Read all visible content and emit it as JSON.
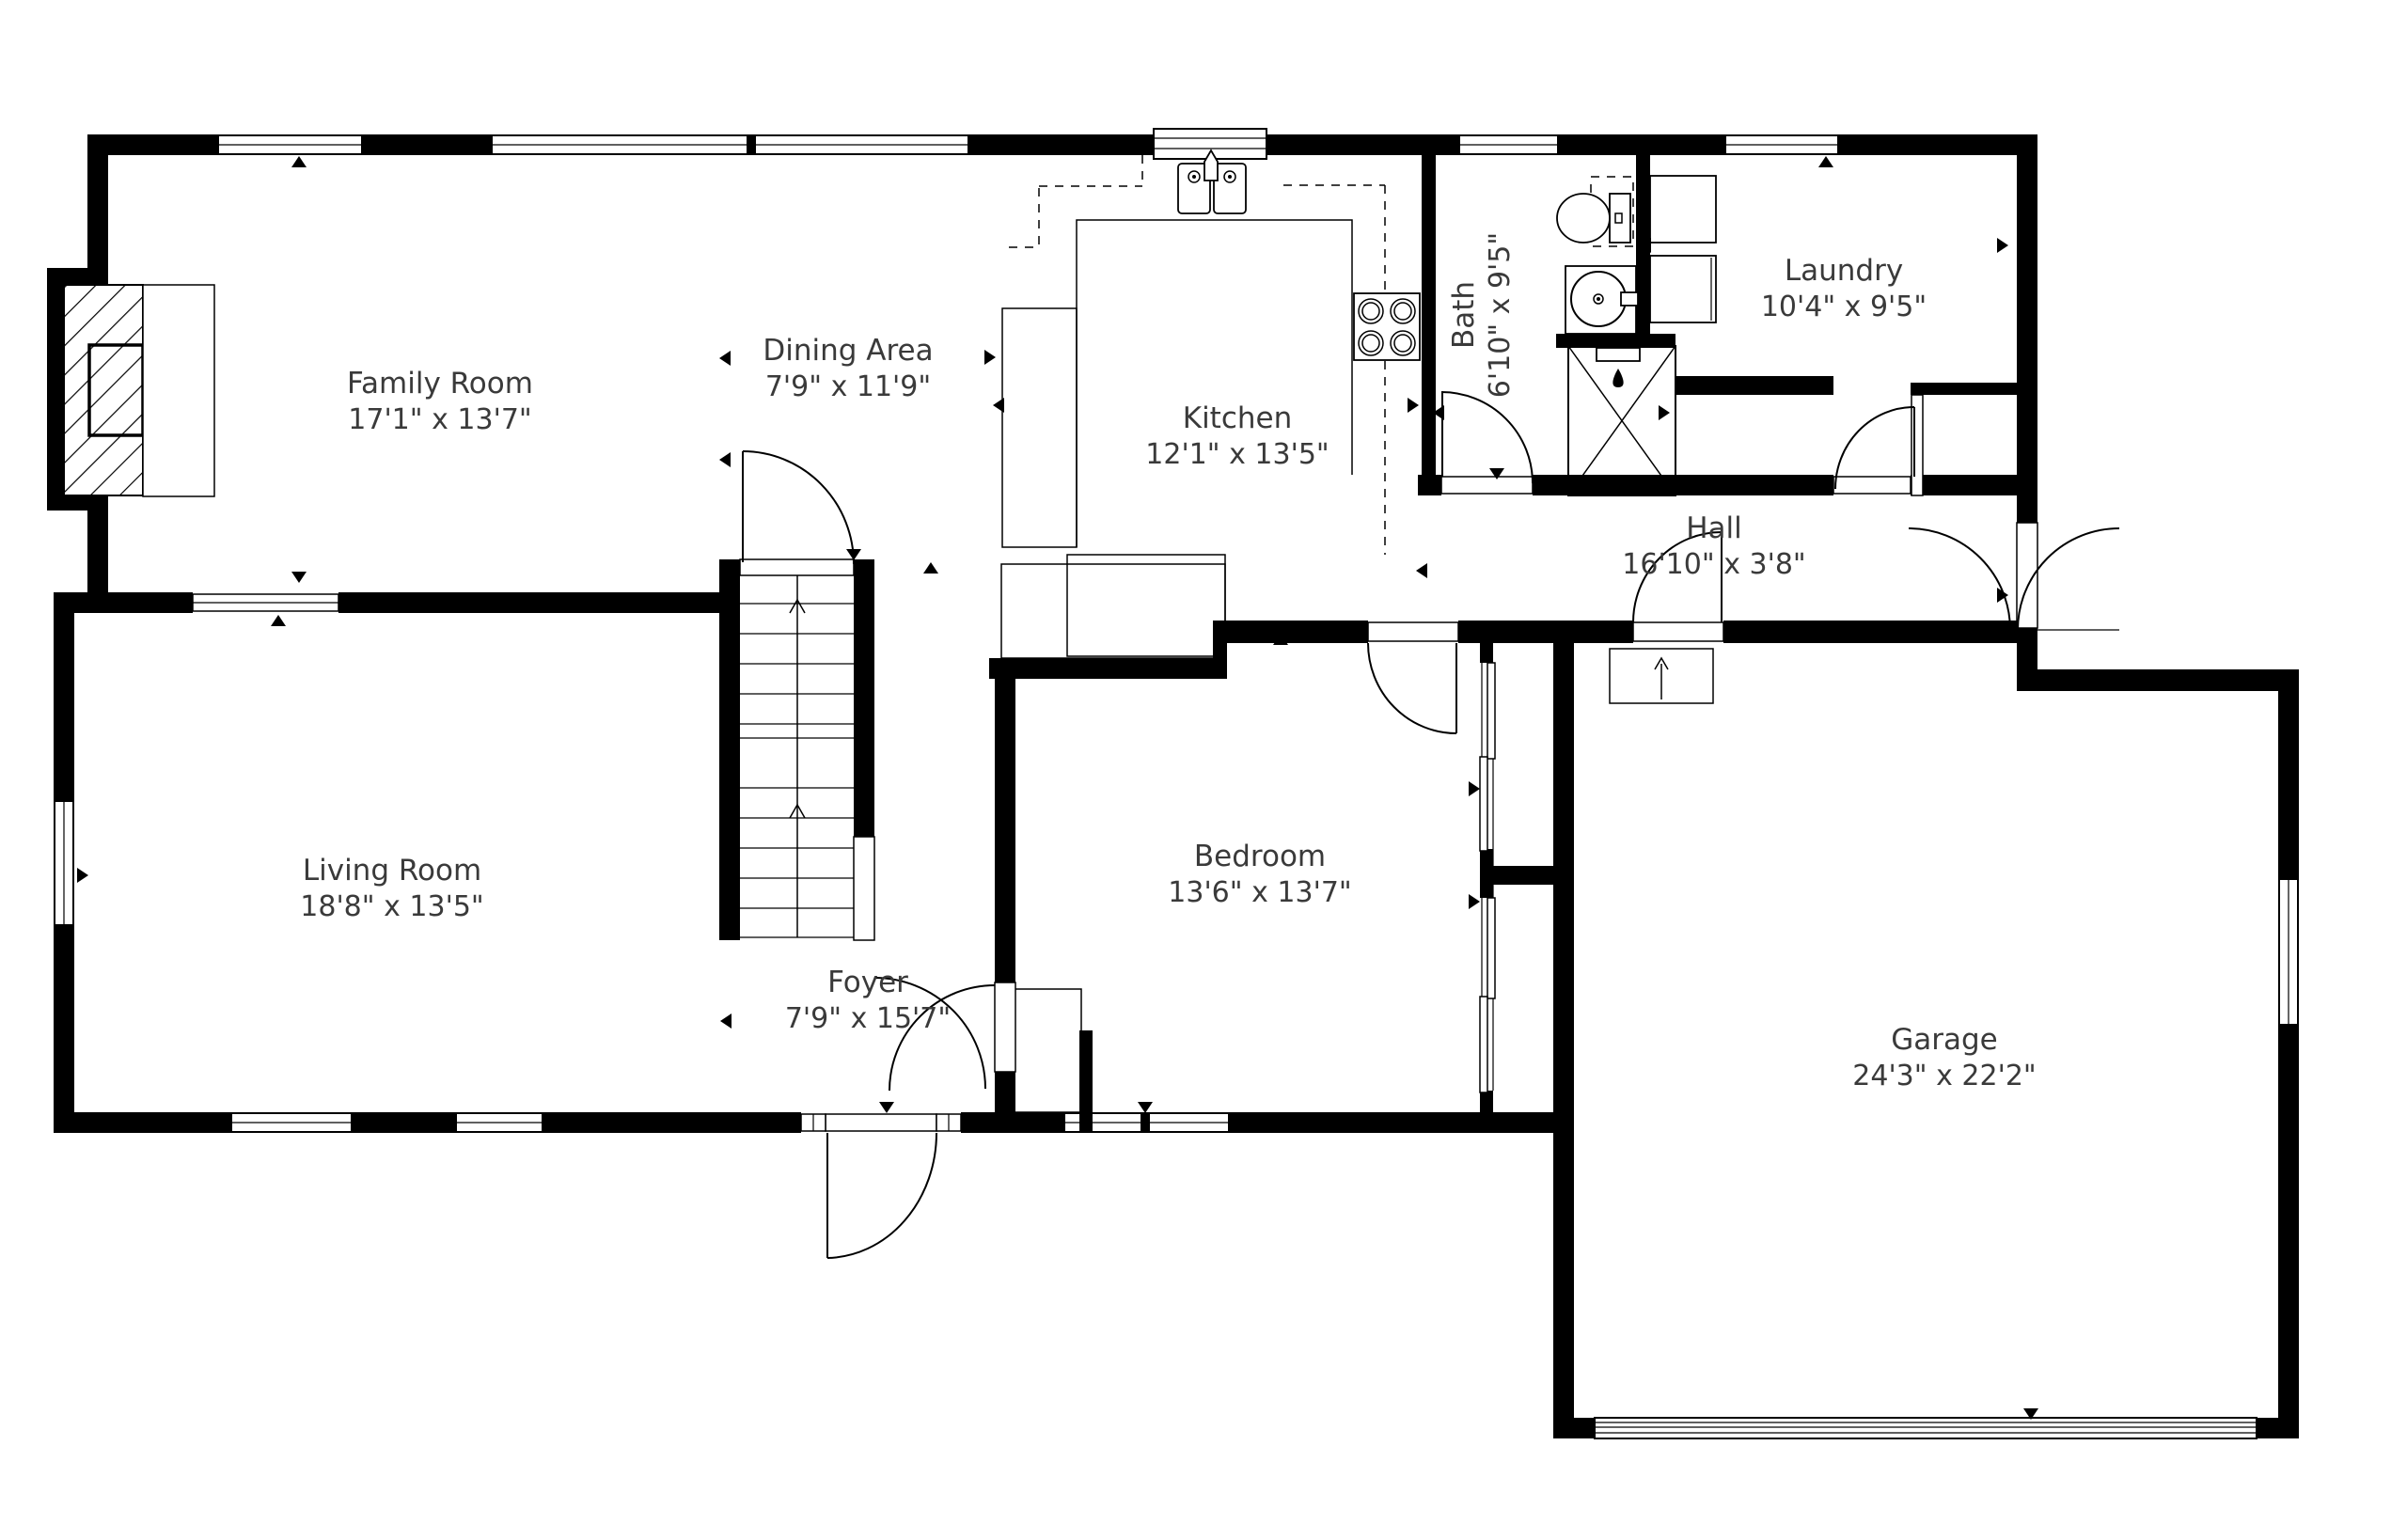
{
  "title": "First Floor Plan",
  "colors": {
    "wall": "#000000",
    "text": "#3a3a3a",
    "background": "#ffffff"
  },
  "rooms": {
    "family_room": {
      "name": "Family Room",
      "dims": "17'1\" x 13'7\""
    },
    "dining_area": {
      "name": "Dining Area",
      "dims": "7'9\" x 11'9\""
    },
    "kitchen": {
      "name": "Kitchen",
      "dims": "12'1\" x 13'5\""
    },
    "bath": {
      "name": "Bath",
      "dims": "6'10\" x 9'5\""
    },
    "laundry": {
      "name": "Laundry",
      "dims": "10'4\" x 9'5\""
    },
    "hall": {
      "name": "Hall",
      "dims": "16'10\" x 3'8\""
    },
    "living_room": {
      "name": "Living Room",
      "dims": "18'8\" x 13'5\""
    },
    "bedroom": {
      "name": "Bedroom",
      "dims": "13'6\" x 13'7\""
    },
    "foyer": {
      "name": "Foyer",
      "dims": "7'9\" x 15'7\""
    },
    "garage": {
      "name": "Garage",
      "dims": "24'3\" x 22'2\""
    }
  }
}
